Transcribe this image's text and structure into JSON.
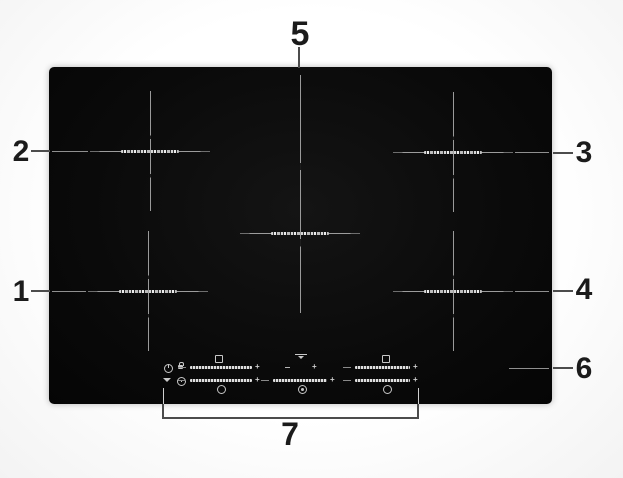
{
  "figure": {
    "subject": "induction-hob-top-view-diagram",
    "callouts": [
      {
        "number": "1"
      },
      {
        "number": "2"
      },
      {
        "number": "3"
      },
      {
        "number": "4"
      },
      {
        "number": "5"
      },
      {
        "number": "6"
      },
      {
        "number": "7"
      }
    ],
    "glyphs": {
      "plus": "+"
    },
    "colors": {
      "background": "#fbfbfb",
      "hob_surface": "#0a0a0a",
      "zone_marking": "#9a9a9a",
      "leader_line": "#4c4c4c",
      "callout_text": "#1b1b1b",
      "control_icons": "#c8c8c8"
    },
    "control_panel_icons": [
      "power-icon",
      "key-lock-icon",
      "fan-icon",
      "timer-icon",
      "zone-select-square-icon",
      "zone-select-circle-icon",
      "bridge-zone-icon",
      "plus-icon",
      "minus-icon",
      "power-slider"
    ]
  }
}
